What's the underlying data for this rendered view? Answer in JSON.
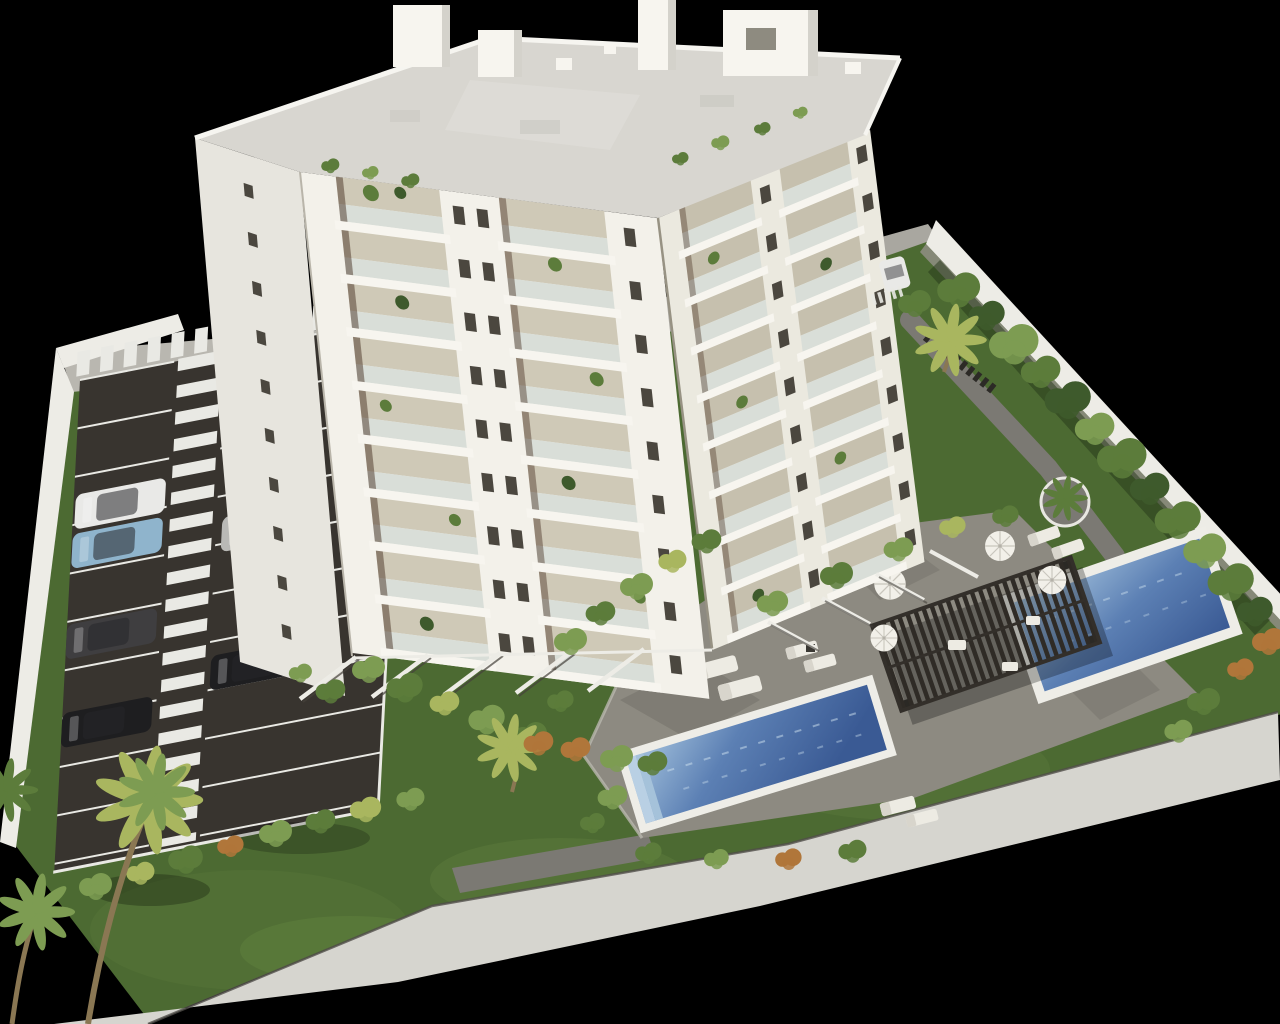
{
  "meta": {
    "kind": "architectural-3d-rendering",
    "subject": "aerial visualization of a white residential apartment tower with landscaped grounds, parking lot, two swimming pools and pergola on black background",
    "canvas": {
      "width": 1280,
      "height": 1024
    }
  },
  "objects": [
    "apartment-tower",
    "rooftop-penthouses",
    "balconies",
    "parking-lot",
    "zebra-crosswalk",
    "parked-cars",
    "perimeter-wall",
    "sidewalk",
    "lawn",
    "ornamental-trees",
    "palm-trees",
    "pool-deck",
    "swimming-pool-long",
    "swimming-pool-small",
    "pergola",
    "sun-loungers",
    "parasols"
  ],
  "colors": {
    "bg": "#000000",
    "grass": "#4c6a32",
    "grassLight": "#6a8a45",
    "grassDark": "#243518",
    "asphalt": "#38342f",
    "stripe": "#e9e9e4",
    "sidewalk": "#d6d5cf",
    "pavement": "#b9b7b0",
    "wallWhite": "#edece6",
    "wallShade": "#908e85",
    "facade": "#f3f1ea",
    "facadeShade": "#ebe9df",
    "facadeSide": "#e7e5de",
    "balcony": "#cfc9b7",
    "balconyShade": "#c6c0ae",
    "glass": "#d9ded8",
    "slab": "#f7f5ef",
    "window": "#4b473f",
    "roof": "#d8d6d0",
    "parapet": "#f6f5f0",
    "deck": "#8d8a81",
    "deckDark": "#605d56",
    "path": "#7b7973",
    "poolBorder": "#eeede7",
    "waterLight": "#a6c4de",
    "waterMid": "#5c80b4",
    "waterDeep": "#3a5a94",
    "pergola": "#45403a",
    "pergolaSlat": "#2f2b26",
    "umbrella": "#f2f0e9",
    "lounger": "#edebe3",
    "trunk": "#8a7753",
    "leafDark": "#3e5a2c",
    "leafMid": "#5c7c3b",
    "leafLight": "#7d9c52",
    "leafYellow": "#a9b65f",
    "leafOrange": "#b0763a",
    "carWhite": "#e9e9e7",
    "carSilver": "#b9b9b6",
    "carBlue": "#8fb4cc",
    "carDark": "#3f3e40",
    "carBlack": "#1e1e20"
  }
}
